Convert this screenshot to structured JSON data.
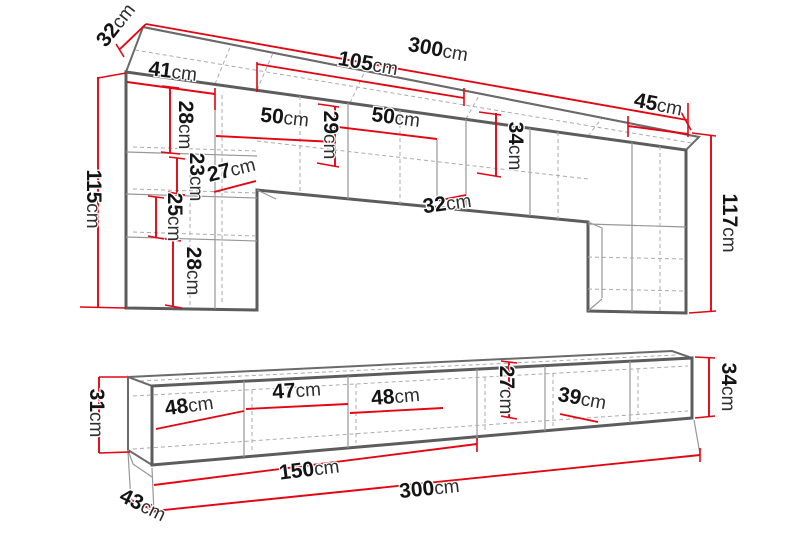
{
  "page": {
    "kind": "furniture-dimension-diagram",
    "background": "#ffffff",
    "units": "cm"
  },
  "colors": {
    "dimension_red": "#e30613",
    "outline_dark": "#5c5c5c",
    "interior_gray": "#979797",
    "hidden_dash_gray": "#ababab",
    "label_black": "#141414"
  },
  "top_unit": {
    "description": "Wall-mounted bridge cabinet unit (upper section)",
    "overall": {
      "width": "300cm",
      "depth": "32cm",
      "height_left": "115cm",
      "height_right": "117cm"
    },
    "labels": [
      {
        "id": "top-depth",
        "num": "32",
        "unit": "cm"
      },
      {
        "id": "top-total-width",
        "num": "300",
        "unit": "cm"
      },
      {
        "id": "top-mid-width",
        "num": "105",
        "unit": "cm"
      },
      {
        "id": "left-column-width",
        "num": "41",
        "unit": "cm"
      },
      {
        "id": "left-seg-1-height",
        "num": "28",
        "unit": "cm"
      },
      {
        "id": "bridge-shelf-left",
        "num": "50",
        "unit": "cm"
      },
      {
        "id": "bridge-inner-height",
        "num": "29",
        "unit": "cm"
      },
      {
        "id": "bridge-shelf-right",
        "num": "50",
        "unit": "cm"
      },
      {
        "id": "bridge-height",
        "num": "34",
        "unit": "cm"
      },
      {
        "id": "right-column-width",
        "num": "45",
        "unit": "cm"
      },
      {
        "id": "left-seg-2-height",
        "num": "23",
        "unit": "cm"
      },
      {
        "id": "left-lower-depth",
        "num": "27",
        "unit": "cm"
      },
      {
        "id": "left-seg-3-height",
        "num": "25",
        "unit": "cm"
      },
      {
        "id": "left-seg-4-height",
        "num": "28",
        "unit": "cm"
      },
      {
        "id": "left-column-height",
        "num": "115",
        "unit": "cm"
      },
      {
        "id": "arch-opening-depth",
        "num": "32",
        "unit": "cm"
      },
      {
        "id": "right-column-height",
        "num": "117",
        "unit": "cm"
      }
    ]
  },
  "bottom_unit": {
    "description": "TV lowboard bench (lower section)",
    "overall": {
      "width": "300cm",
      "depth": "43cm",
      "height_left": "31cm",
      "height_right": "34cm"
    },
    "labels": [
      {
        "id": "bench-left-height",
        "num": "31",
        "unit": "cm"
      },
      {
        "id": "bench-comp-1-width",
        "num": "48",
        "unit": "cm"
      },
      {
        "id": "bench-comp-2-width",
        "num": "47",
        "unit": "cm"
      },
      {
        "id": "bench-comp-3-width",
        "num": "48",
        "unit": "cm"
      },
      {
        "id": "bench-inner-height",
        "num": "27",
        "unit": "cm"
      },
      {
        "id": "bench-comp-4-width",
        "num": "39",
        "unit": "cm"
      },
      {
        "id": "bench-right-height",
        "num": "34",
        "unit": "cm"
      },
      {
        "id": "bench-half-width",
        "num": "150",
        "unit": "cm"
      },
      {
        "id": "bench-total-width",
        "num": "300",
        "unit": "cm"
      },
      {
        "id": "bench-depth",
        "num": "43",
        "unit": "cm"
      }
    ]
  }
}
